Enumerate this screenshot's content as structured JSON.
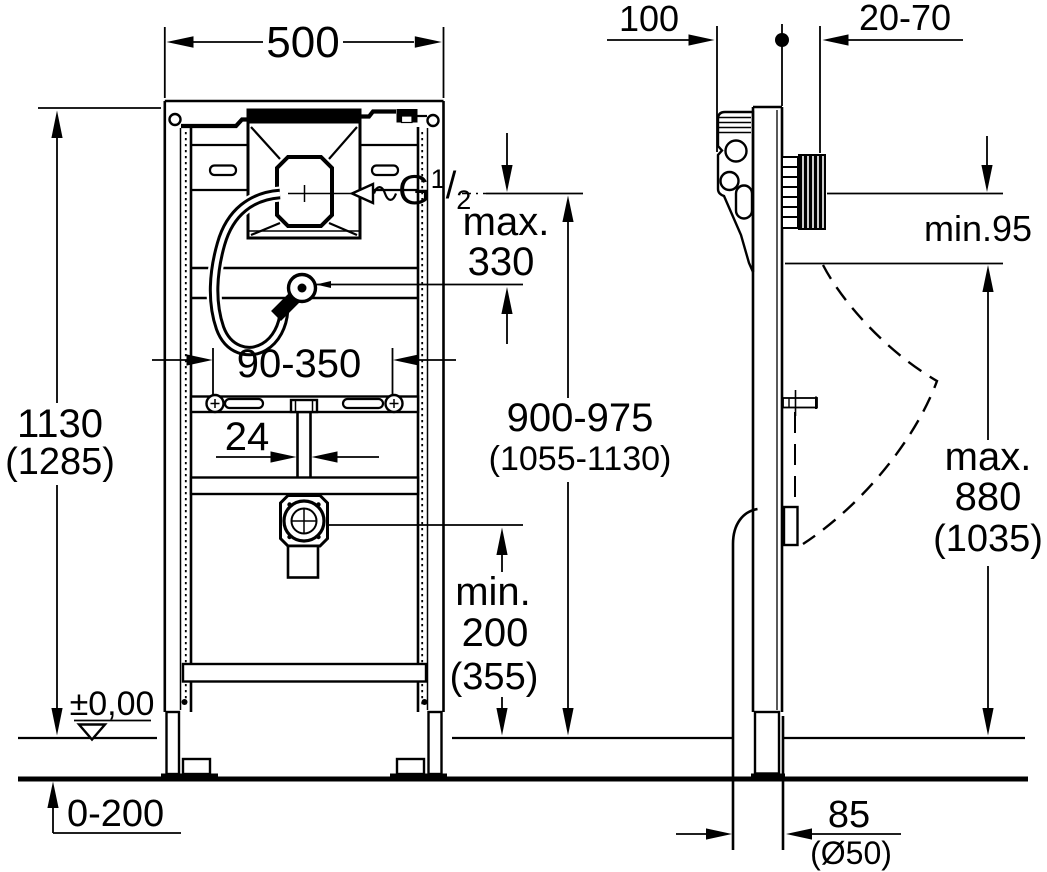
{
  "front_view": {
    "frame_width": "500",
    "frame_height": "1130",
    "frame_height_alt": "(1285)",
    "water_connection": {
      "base": "G",
      "sup": "1",
      "slash": "/",
      "sub": "2"
    },
    "connection_offset_max": {
      "line1": "max.",
      "line2": "330"
    },
    "fixing_spacing": "90-350",
    "flush_pipe_width": "24",
    "mounting_height": "900-975",
    "mounting_height_alt": "(1055-1130)",
    "drain_min_height": {
      "line1": "min.",
      "line2": "200",
      "line3": "(355)"
    },
    "floor_level": "±0,00",
    "floor_range": "0-200"
  },
  "side_view": {
    "frame_depth": "100",
    "finish_wall_range": "20-70",
    "min_inset": "min.95",
    "urinal_max_height": {
      "line1": "max.",
      "line2": "880",
      "line3": "(1035)"
    },
    "drain_offset": "85",
    "drain_pipe_diameter": "(Ø50)"
  }
}
